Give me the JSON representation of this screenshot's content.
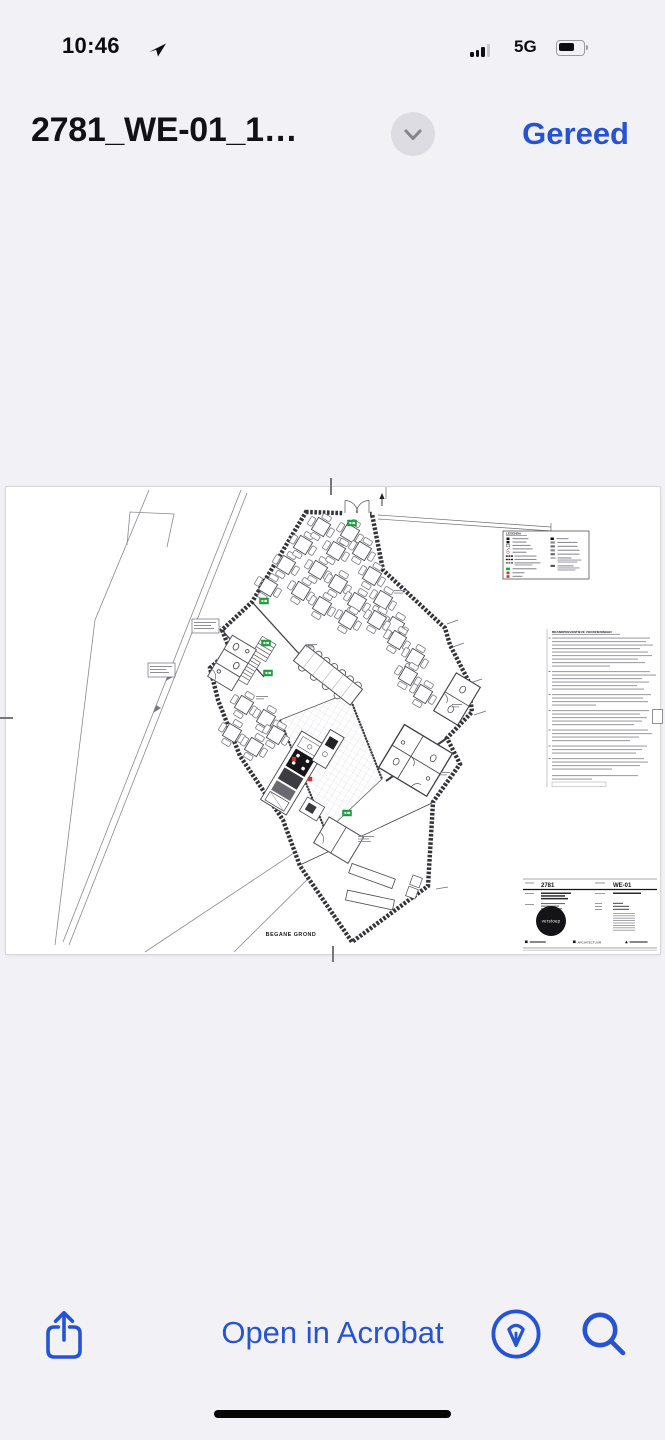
{
  "status_bar": {
    "time": "10:46",
    "network": "5G",
    "battery_level_percent": 72
  },
  "nav": {
    "title": "2781_WE-01_1…",
    "done_button": "Gereed"
  },
  "sheet": {
    "floor_label": "BEGANE GROND",
    "legend_title": "LEGENDA",
    "notes_heading": "BRANDPREVENTIEVE VOORZIENINGEN",
    "titleblock": {
      "project_number": "2781",
      "sheet_code": "WE-01",
      "logo_text": "verstoep",
      "discipline_label": "ARCHITECTUUR"
    }
  },
  "toolbar": {
    "open_in_acrobat": "Open in Acrobat"
  },
  "icons": {
    "location": "location-arrow-icon",
    "cellular": "cellular-signal-icon",
    "battery": "battery-icon",
    "chevron": "chevron-down-icon",
    "share": "share-icon",
    "markup": "markup-icon",
    "search": "search-icon"
  },
  "colors": {
    "accent_blue": "#2653D4",
    "exit_green": "#18A73C",
    "alarm_red": "#CF3527",
    "paper": "#FFFFFF",
    "background": "#F2F2F6"
  }
}
